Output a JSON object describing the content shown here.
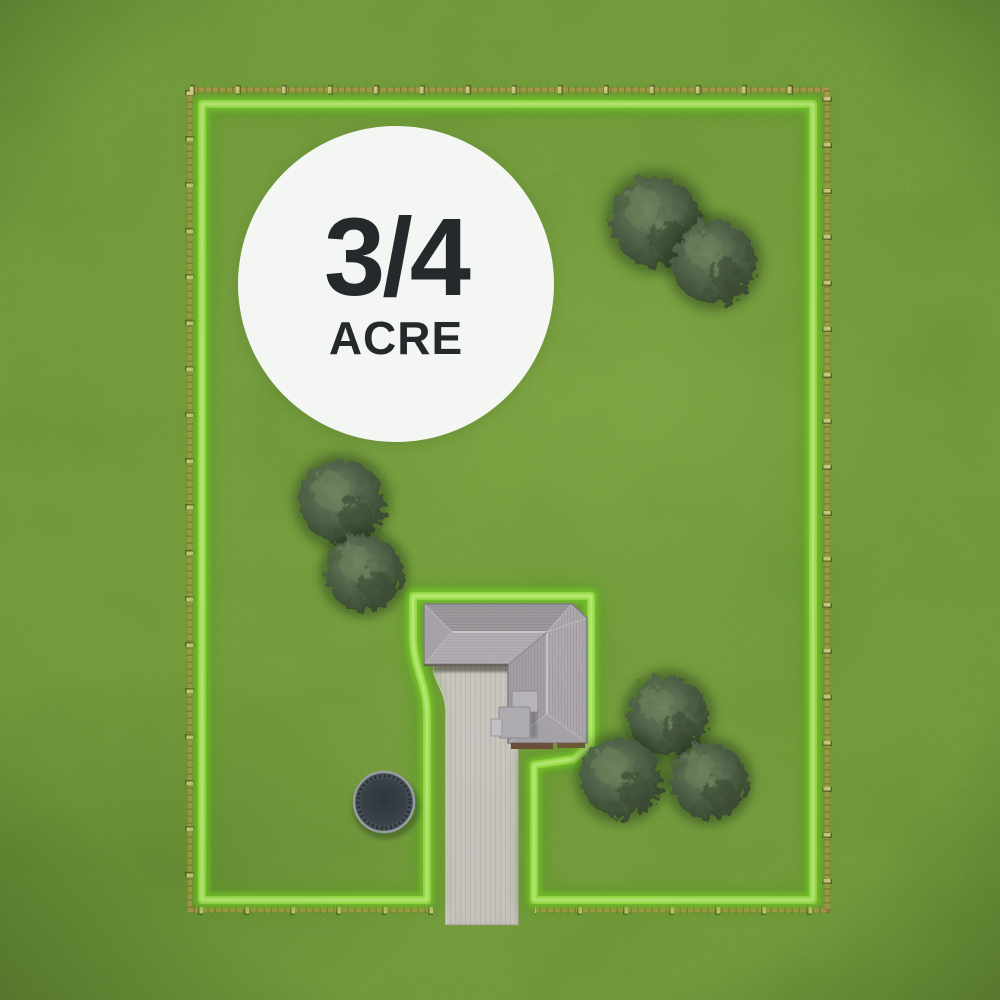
{
  "badge": {
    "fraction": "3/4",
    "unit": "ACRE"
  },
  "colors": {
    "grass-base": "#7aa43e",
    "boundary-glow": "#58a01d",
    "boundary-main": "#74c32a",
    "boundary-core": "#92da40",
    "boundary-hot": "#c6f28a",
    "fence-rail": "#bb9a58",
    "fence-tick": "#8a6d35",
    "fence-post": "#ecd89f",
    "driveway-fill": "#cbc8c2",
    "roof-base": "#aaa6ab",
    "roof-north": "#9e9a9f",
    "roof-south": "#b6b2b7",
    "roof-east": "#b1adb2",
    "roof-west": "#a6a2a7",
    "wall-brown": "#6f4f39",
    "tree-mid": "#50634a",
    "tree-light": "#72855f",
    "tree-dark": "#39482f",
    "tree-shadow": "#1f3114",
    "trampoline-mat": "#353c44",
    "trampoline-rim": "#9aa0a4",
    "badge-bg": "#f4f6f3",
    "badge-text": "#26292c"
  }
}
